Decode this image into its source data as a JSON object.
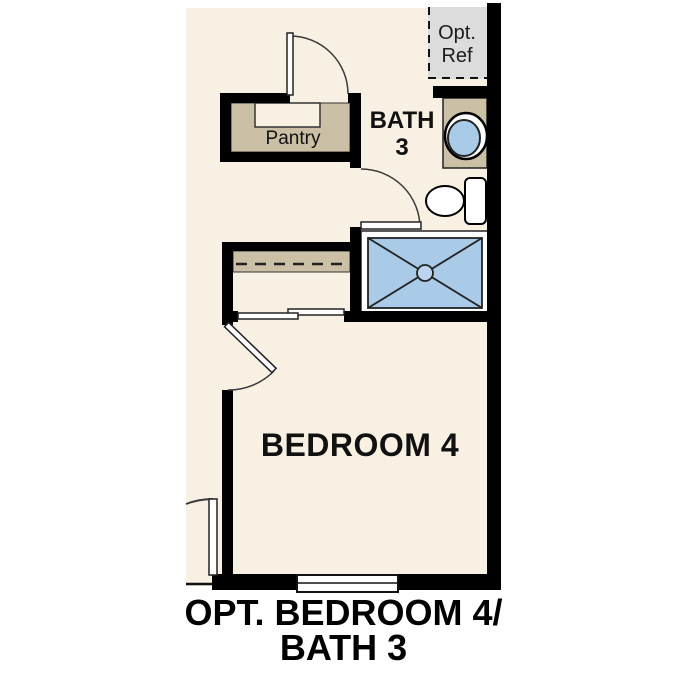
{
  "caption": {
    "line1": "OPT. BEDROOM 4/",
    "line2": "BATH 3"
  },
  "rooms": {
    "bedroom4": {
      "label": "BEDROOM 4"
    },
    "bath3": {
      "label_line1": "BATH",
      "label_line2": "3"
    },
    "pantry": {
      "label": "Pantry"
    },
    "opt_ref": {
      "label_line1": "Opt.",
      "label_line2": "Ref"
    }
  },
  "fixtures": {
    "shower": "shower-pan-with-x-and-drain",
    "sink": "oval-vanity-sink-on-counter",
    "toilet": "toilet-with-tank",
    "closet": "closet-shelf-with-dashed-rod",
    "closet_doors": "bypass-sliding-doors",
    "doors": [
      "pantry-hinged-door",
      "bath-hinged-door",
      "bedroom-hinged-door",
      "exterior-hinged-door"
    ],
    "window": "bedroom-window",
    "opt_ref_box": "optional-refrigerator-dashed-area"
  },
  "colors": {
    "floor_cream": "#f7f0e3",
    "cabinet_tan": "#cbbfa5",
    "fixture_blue": "#a9cbe8",
    "drain_blue": "#bcd5ee",
    "opt_ref_gray": "#dcdcdc",
    "wall_black": "#000000",
    "line_dark": "#333333"
  }
}
